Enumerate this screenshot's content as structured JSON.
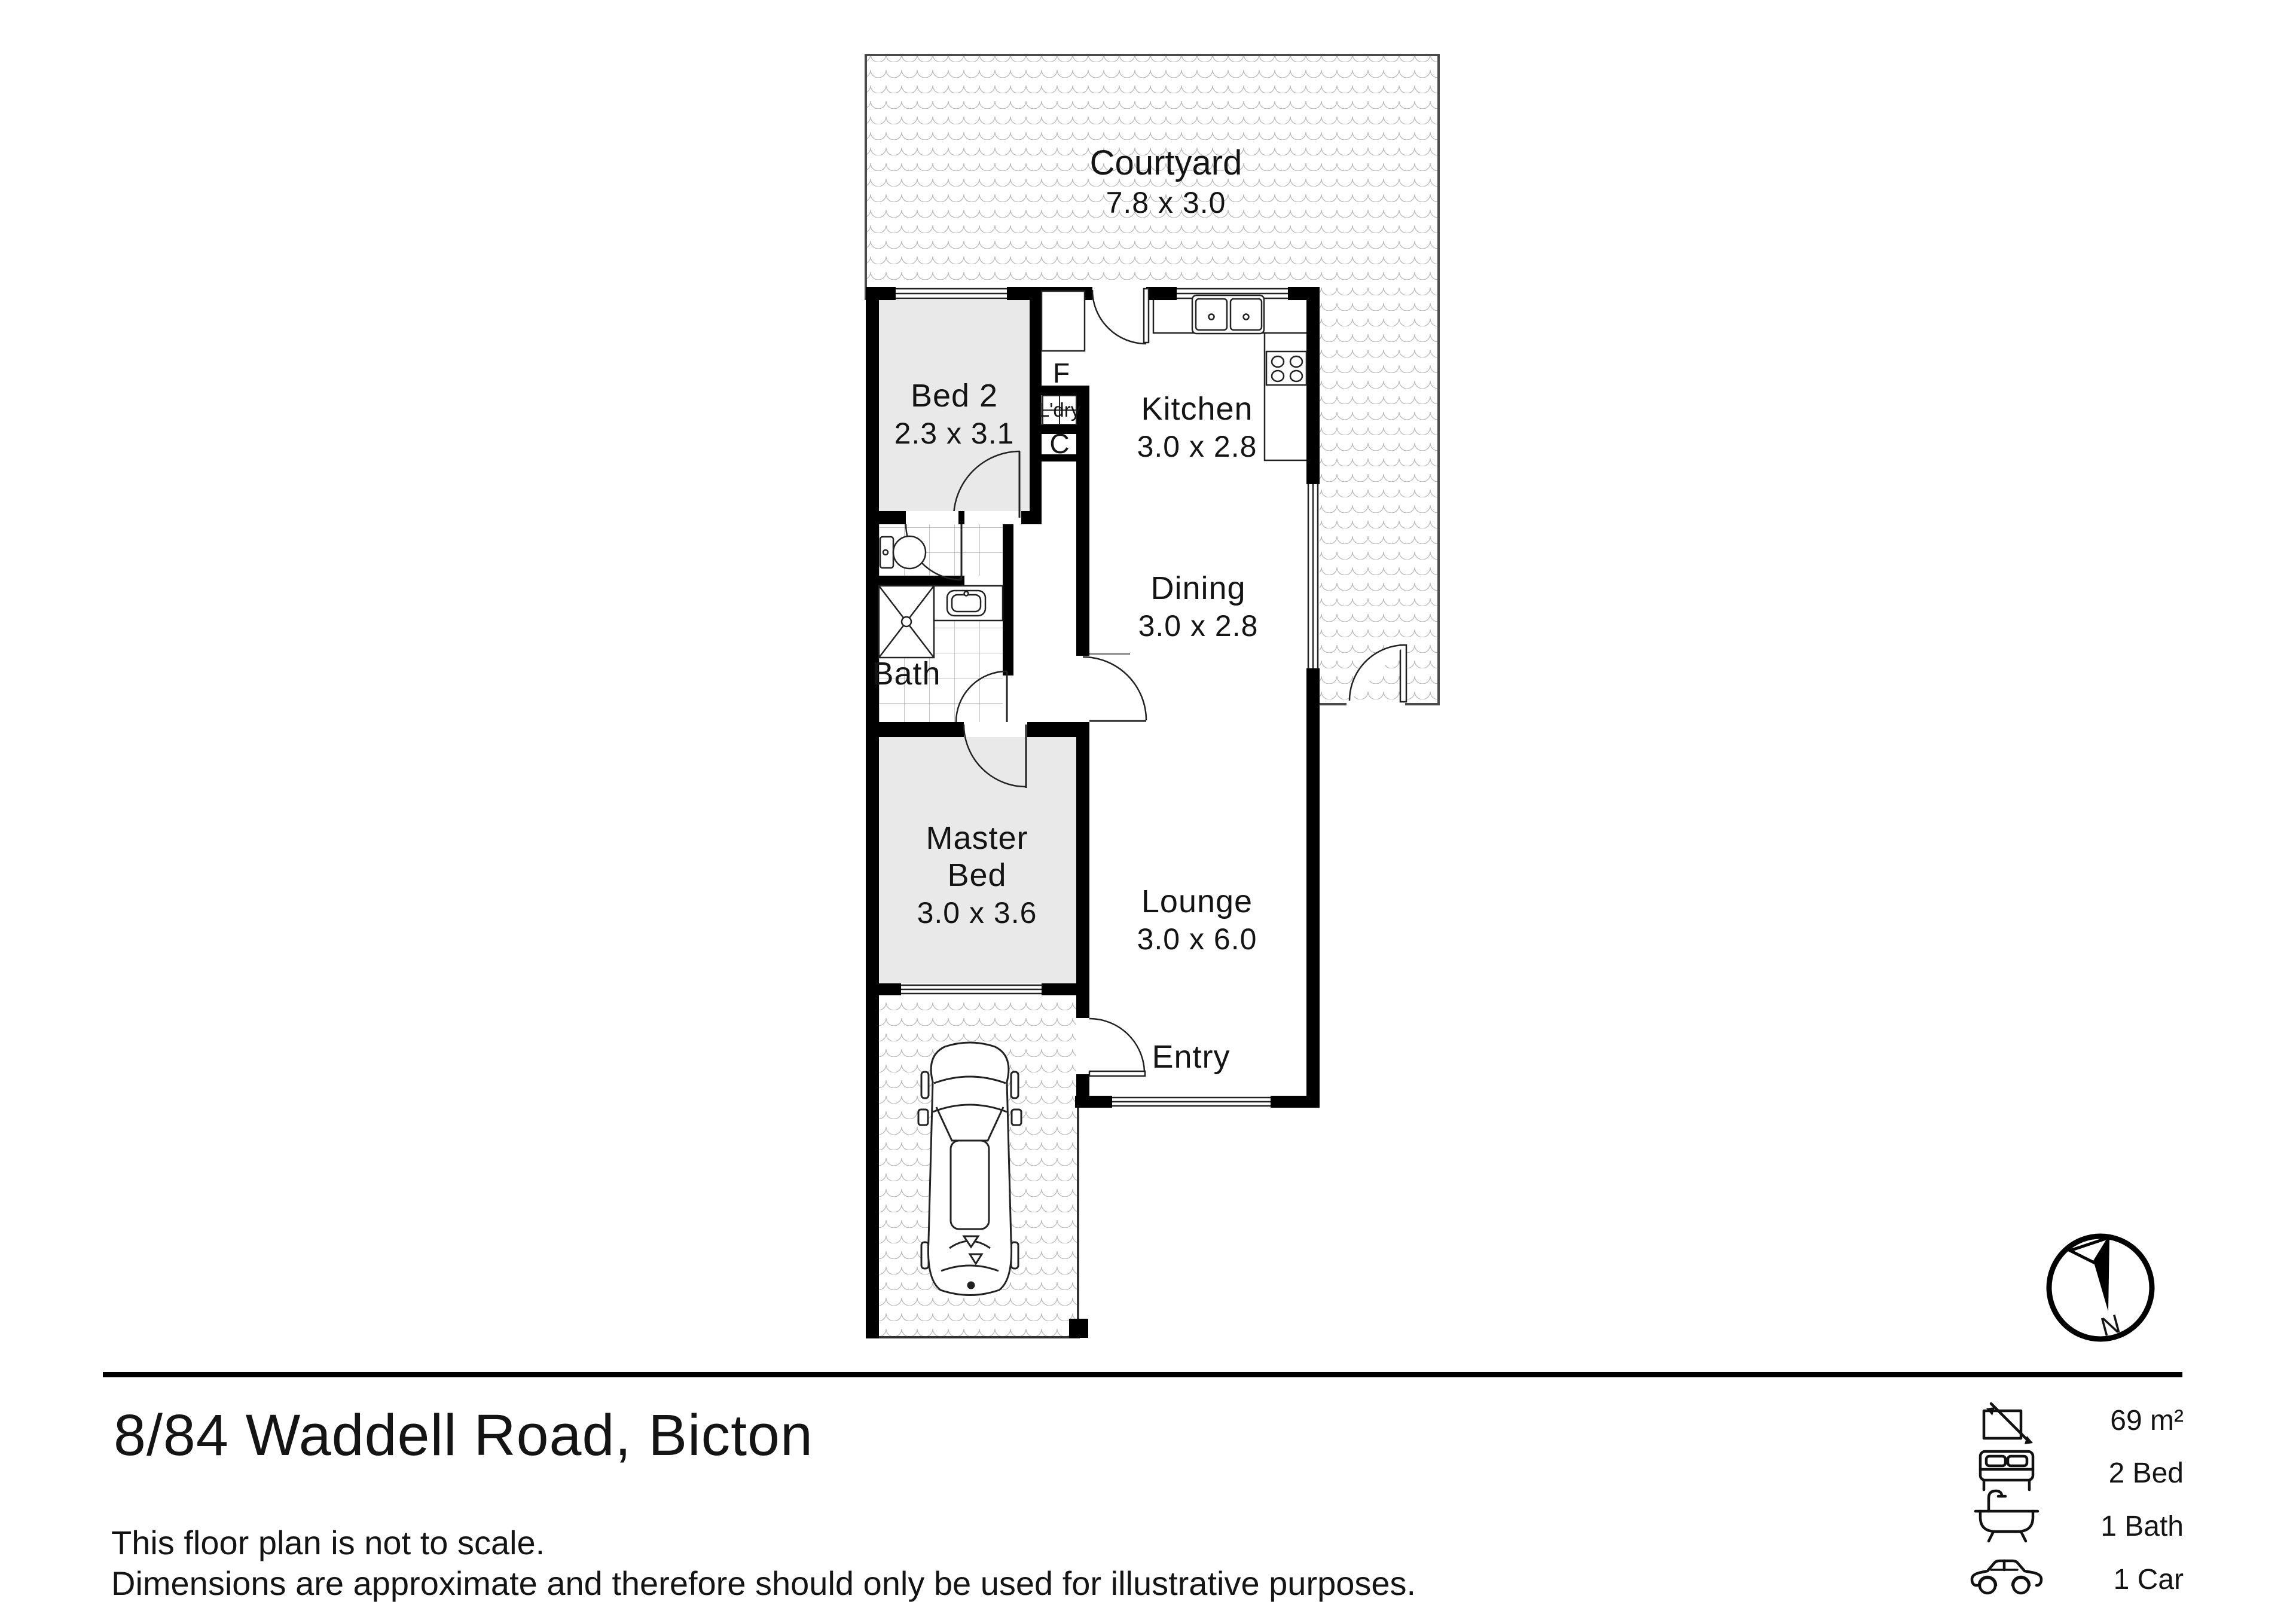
{
  "plan": {
    "rooms": [
      {
        "name": "Courtyard",
        "dims": "7.8 x 3.0"
      },
      {
        "name": "Bed 2",
        "dims": "2.3 x 3.1"
      },
      {
        "name": "Kitchen",
        "dims": "3.0 x 2.8"
      },
      {
        "name": "Dining",
        "dims": "3.0 x 2.8"
      },
      {
        "name": "Bath"
      },
      {
        "line1": "Master",
        "line2": "Bed",
        "dims": "3.0 x 3.6"
      },
      {
        "name": "Lounge",
        "dims": "3.0 x 6.0"
      },
      {
        "name": "Entry"
      }
    ],
    "closets": {
      "fridge": "F",
      "laundry": "L'dry",
      "cupboard": "C"
    },
    "compass": {
      "north": "N"
    },
    "colors": {
      "walls": "#000000",
      "room_fill": "#e9e9e9",
      "hatch_line": "#b5b5b5"
    }
  },
  "footer": {
    "title": "8/84 Waddell Road, Bicton",
    "disclaimer_line1": "This floor plan is not to scale.",
    "disclaimer_line2": "Dimensions are approximate and therefore should only be used for illustrative purposes.",
    "stats": [
      {
        "icon": "area-icon",
        "label": "69 m²"
      },
      {
        "icon": "bed-icon",
        "label": "2 Bed"
      },
      {
        "icon": "bath-icon",
        "label": "1 Bath"
      },
      {
        "icon": "car-icon",
        "label": "1 Car"
      }
    ]
  }
}
